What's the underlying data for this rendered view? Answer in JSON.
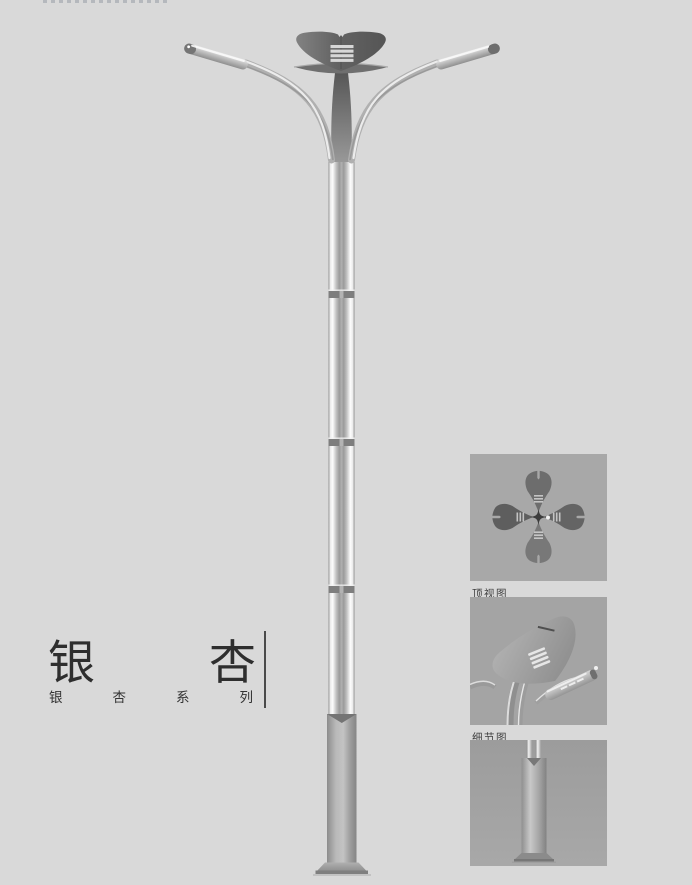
{
  "page": {
    "background": "#d9d9d9"
  },
  "product": {
    "title": "银杏",
    "title_chars": [
      "银",
      "杏"
    ],
    "series": "银杏系列",
    "series_chars": [
      "银",
      "杏",
      "系",
      "列"
    ]
  },
  "thumbnails": {
    "top_view": {
      "label": "顶视图"
    },
    "detail_view": {
      "label": "细节图"
    },
    "base_view": {
      "label": ""
    }
  },
  "colors": {
    "page_bg": "#d9d9d9",
    "panel_bg": "#a6a6a6",
    "lamp_head": "#5f5f5f",
    "pole_metal": "#b9b9b9",
    "title_text": "#2e2e2e",
    "divider": "#4a4a4a"
  }
}
